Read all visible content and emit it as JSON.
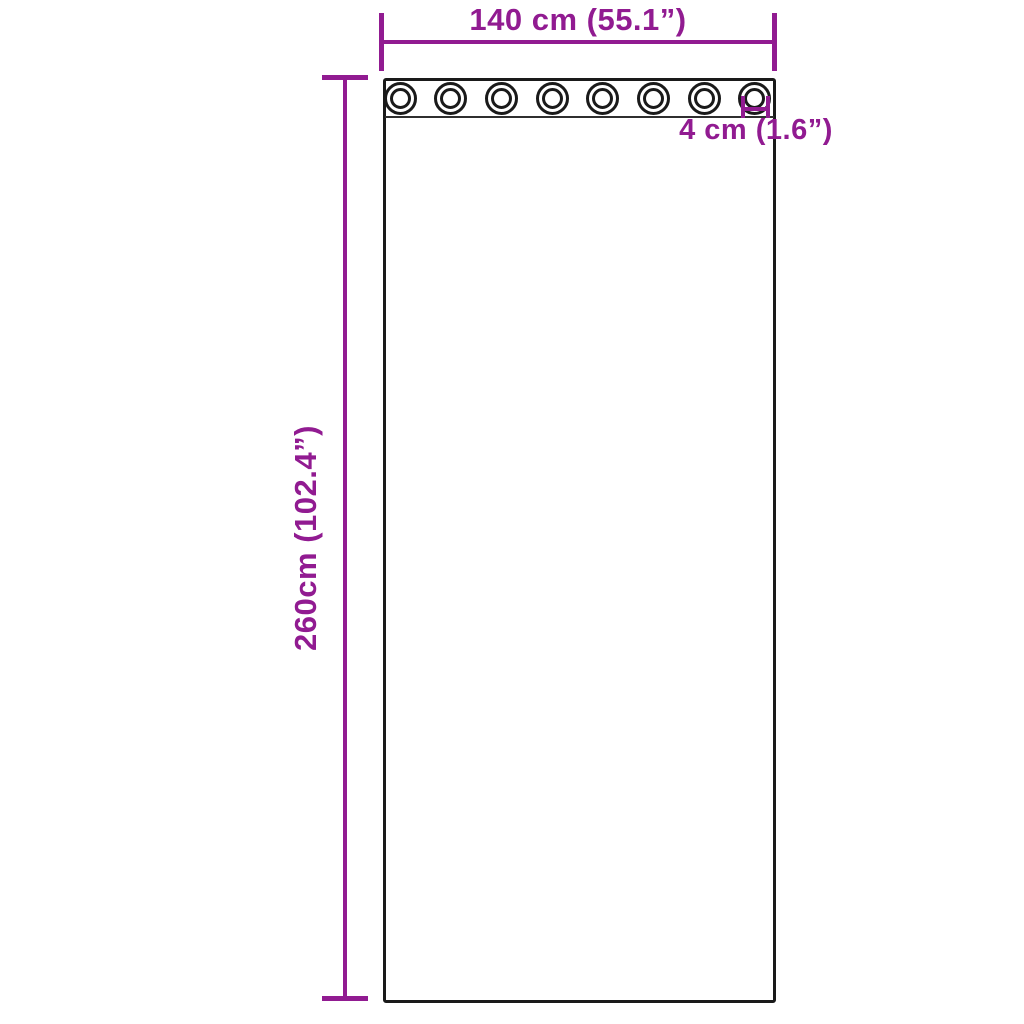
{
  "diagram": {
    "type": "product-dimension-diagram",
    "subject": "grommet-curtain-panel",
    "background": "#ffffff",
    "accent_color": "#911B91",
    "outline_color": "#1a1a1a",
    "width_label": "140 cm (55.1”)",
    "height_label": "260cm (102.4”)",
    "grommet_label": "4 cm (1.6”)",
    "grommets": {
      "count": 8,
      "first_center_x": 400,
      "spacing": 50.7
    }
  }
}
